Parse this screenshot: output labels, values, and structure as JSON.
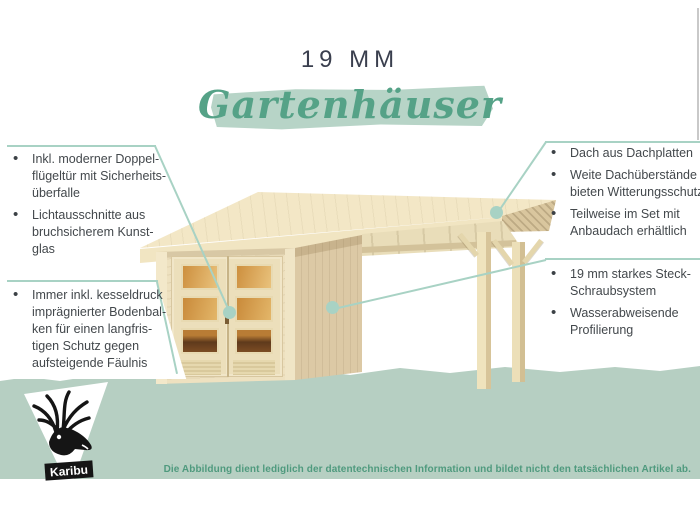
{
  "header": {
    "size_label": "19 MM",
    "title": "Gartenhäuser"
  },
  "bullets_left_top": {
    "items": [
      {
        "lines": [
          "Inkl. moderner Doppel-",
          "flügeltür mit Sicherheits-",
          "überfalle"
        ]
      },
      {
        "lines": [
          "Lichtausschnitte aus",
          "bruchsicherem Kunst-",
          "glas"
        ]
      }
    ]
  },
  "bullets_left_bottom": {
    "items": [
      {
        "lines": [
          "Immer inkl. kesseldruck",
          "imprägnierter Bodenbal-",
          "ken für einen langfris-",
          "tigen Schutz gegen",
          "aufsteigende Fäulnis"
        ]
      }
    ]
  },
  "bullets_right_top": {
    "items": [
      {
        "lines": [
          "Dach aus Dachplatten"
        ]
      },
      {
        "lines": [
          "Weite Dachüberstände",
          "bieten Witterungsschutz"
        ]
      },
      {
        "lines": [
          "Teilweise im Set mit",
          "Anbaudach erhältlich"
        ]
      }
    ]
  },
  "bullets_right_bottom": {
    "items": [
      {
        "lines": [
          "19 mm starkes Steck-",
          "Schraubsystem"
        ]
      },
      {
        "lines": [
          "Wasserabweisende",
          "Profilierung"
        ]
      }
    ]
  },
  "footer": {
    "disclaimer": "Die Abbildung dient lediglich der datentechnischen Information und bildet nicht den tatsächlichen Artikel ab.",
    "logo_text": "Karibu"
  },
  "illustration": {
    "subject": "wooden garden house with double glass door and attached flat-roof canopy on two posts",
    "icons": [
      "deer-logo"
    ]
  },
  "colors": {
    "accent_green": "#55a287",
    "brush_green": "#b7d4c7",
    "band_green": "#b6cfc2",
    "callout_line": "#a8d2c4",
    "heading_dark": "#3a3f4e",
    "body_text": "#43484c",
    "wood_front": "#eee1c0",
    "wood_side": "#dcc9a5",
    "roof_wood": "#f3e7c6",
    "glass_amber": "#cd8f3e"
  }
}
